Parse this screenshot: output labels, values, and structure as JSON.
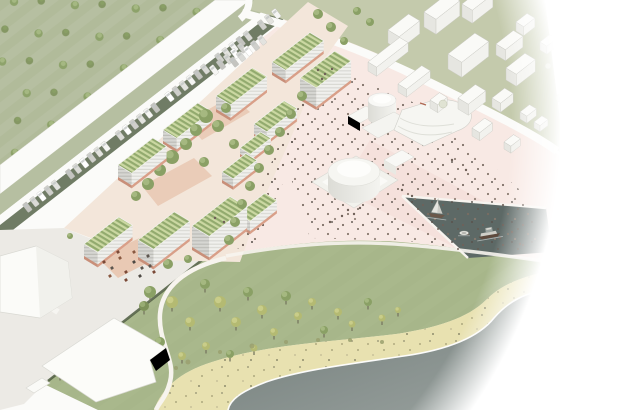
{
  "meta": {
    "alt": "Aerial architectural masterplan rendering in a circular vignette: green-roof campus, plaza, harbor basin with boats, meadow, beach and sea"
  },
  "palette": {
    "field": "#b6bfa1",
    "fieldStripe": "#adb795",
    "context": "#c4caac",
    "meadow": "#a9b88c",
    "meadowStripe": "#a0b081",
    "beach": "#e8e1b0",
    "seaTop": "#6f7a77",
    "seaBot": "#9ba3a0",
    "basin": "#5d6966",
    "white": "#fbfbf9",
    "grey": "#eceae5",
    "plaza": "#f8e9e4",
    "plaza2": "#f2dbd6",
    "campusGround": "#f3e6da",
    "court": "#e9c9b4",
    "hedge": "#4e5c40",
    "tree": "#8aa065",
    "treeLight": "#a9bc85",
    "treeDark": "#7d9159",
    "treeDarkHi": "#9cb078",
    "poplar": "#b4ba72",
    "poplarHi": "#ccd08d",
    "trunk": "#77775f",
    "roofA": "#cbd8a2",
    "roofB": "#92aa6e",
    "facL": "#d6d6d2",
    "facLLine": "#bdbdb8",
    "facR": "#f0f0ed",
    "facRLine": "#d9d9d4",
    "base": "#d99f88",
    "base2": "#c98f79",
    "ctxRoof": "#fafaf7",
    "ctxL": "#e6e6e1",
    "ctxR": "#f2f2ee",
    "ctxLine": "#c9c9c3",
    "sphere": "#e0e3d3",
    "sphereLine": "#c2c6b2",
    "bush": "#9aa06e",
    "dot": "#6f6058",
    "foam": "#ffffff",
    "sailHull": "#6b584a",
    "sail": "#e4e4df",
    "sail2": "#cbcbc5",
    "tugHull": "#5e4a3d",
    "tugDeck": "#cfcfc8",
    "tugCabin": "#9aa29e",
    "car_colors": [
      "#f5f5f3",
      "#e3e3df",
      "#cfcfcb",
      "#ffffff",
      "#dadad6",
      "#c4c4c0"
    ],
    "furn_colors": [
      "#7b4a37",
      "#5d564f",
      "#8a5a42",
      "#4e4a44"
    ]
  },
  "scene": {
    "vignette": {
      "cx": 61,
      "cy": 125,
      "r": 500
    },
    "axes": {
      "ux": 0.79,
      "uy": -0.614,
      "vx": 0.86,
      "vy": 0.52
    },
    "campus_buildings_back": [
      [
        272,
        62,
        48,
        16,
        13
      ],
      [
        300,
        78,
        44,
        19,
        22
      ],
      [
        216,
        96,
        46,
        17,
        16
      ],
      [
        254,
        124,
        38,
        15,
        13
      ],
      [
        163,
        130,
        44,
        16,
        14
      ],
      [
        240,
        148,
        26,
        12,
        9
      ]
    ],
    "campus_buildings_front": [
      [
        118,
        165,
        44,
        16,
        15
      ],
      [
        222,
        172,
        30,
        13,
        11
      ],
      [
        238,
        214,
        34,
        14,
        13
      ],
      [
        192,
        226,
        48,
        20,
        24
      ],
      [
        138,
        240,
        46,
        18,
        20
      ],
      [
        84,
        244,
        44,
        16,
        15
      ]
    ],
    "context_buildings": [
      [
        462,
        4,
        26,
        12,
        13
      ],
      [
        424,
        12,
        30,
        14,
        15
      ],
      [
        388,
        30,
        26,
        13,
        13
      ],
      [
        516,
        22,
        14,
        9,
        9
      ],
      [
        540,
        42,
        12,
        8,
        8
      ],
      [
        496,
        44,
        22,
        11,
        11
      ],
      [
        448,
        54,
        34,
        16,
        15
      ],
      [
        368,
        62,
        40,
        10,
        9
      ],
      [
        506,
        68,
        24,
        12,
        12
      ],
      [
        398,
        84,
        30,
        10,
        8
      ],
      [
        430,
        100,
        12,
        9,
        8
      ],
      [
        458,
        98,
        22,
        12,
        11
      ],
      [
        492,
        98,
        16,
        10,
        9
      ],
      [
        520,
        112,
        12,
        8,
        7
      ],
      [
        534,
        122,
        10,
        7,
        6
      ],
      [
        472,
        128,
        16,
        9,
        8
      ],
      [
        504,
        142,
        12,
        8,
        7
      ]
    ],
    "trees": {
      "courtyard": [
        [
          206,
          116,
          7
        ],
        [
          218,
          126,
          6
        ],
        [
          196,
          130,
          6
        ],
        [
          226,
          108,
          5
        ],
        [
          186,
          144,
          6
        ],
        [
          172,
          157,
          7
        ],
        [
          160,
          170,
          6
        ],
        [
          234,
          144,
          5
        ],
        [
          148,
          184,
          6
        ],
        [
          136,
          196,
          5
        ],
        [
          204,
          162,
          5
        ]
      ],
      "promenade": [
        [
          302,
          96,
          5
        ],
        [
          291,
          114,
          5
        ],
        [
          280,
          132,
          5
        ],
        [
          269,
          150,
          5
        ],
        [
          259,
          168,
          5
        ],
        [
          250,
          186,
          5
        ],
        [
          242,
          204,
          5
        ],
        [
          235,
          222,
          5
        ],
        [
          229,
          240,
          5
        ]
      ],
      "street": [
        [
          318,
          14,
          5
        ],
        [
          331,
          27,
          5
        ],
        [
          344,
          41,
          4
        ],
        [
          357,
          11,
          4
        ],
        [
          370,
          22,
          4
        ]
      ],
      "grey": [
        [
          168,
          264,
          5
        ],
        [
          188,
          259,
          4
        ],
        [
          95,
          243,
          4
        ],
        [
          112,
          251,
          4
        ],
        [
          70,
          236,
          3
        ]
      ],
      "hedge": [
        [
          60,
          372,
          5
        ],
        [
          88,
          350,
          5
        ],
        [
          116,
          328,
          5
        ],
        [
          144,
          306,
          5
        ]
      ],
      "slope": [
        [
          150,
          292,
          6
        ],
        [
          172,
          302,
          6
        ],
        [
          190,
          322,
          5
        ],
        [
          205,
          284,
          5
        ],
        [
          220,
          302,
          6
        ],
        [
          236,
          322,
          5
        ],
        [
          248,
          292,
          5
        ],
        [
          262,
          310,
          5
        ],
        [
          274,
          332,
          4
        ],
        [
          286,
          296,
          5
        ],
        [
          298,
          316,
          4
        ],
        [
          312,
          302,
          4
        ],
        [
          324,
          330,
          4
        ],
        [
          338,
          312,
          4
        ],
        [
          352,
          324,
          3.5
        ],
        [
          368,
          302,
          4
        ],
        [
          382,
          318,
          3.5
        ],
        [
          398,
          310,
          3
        ],
        [
          160,
          342,
          5
        ],
        [
          182,
          356,
          4
        ],
        [
          206,
          346,
          4
        ],
        [
          230,
          354,
          4
        ],
        [
          254,
          348,
          3.5
        ]
      ],
      "spheres": [
        [
          560,
          98,
          4
        ],
        [
          578,
          124,
          4
        ],
        [
          548,
          66,
          3
        ],
        [
          592,
          146,
          3
        ],
        [
          443,
          104,
          4
        ]
      ],
      "beach_bushes": [
        [
          188,
          362,
          2.5
        ],
        [
          220,
          352,
          2
        ],
        [
          252,
          346,
          2.5
        ],
        [
          286,
          342,
          2
        ],
        [
          318,
          340,
          2
        ],
        [
          350,
          340,
          2
        ],
        [
          382,
          342,
          2
        ],
        [
          176,
          368,
          2
        ]
      ]
    },
    "cars": {
      "main": {
        "base": [
          228,
          17
        ],
        "dir": [
          -0.79,
          0.614
        ],
        "normal": [
          0.614,
          0.79
        ],
        "offset": 27,
        "start": -40,
        "step": 9,
        "count": 36,
        "skip": [
          3,
          9,
          16,
          23,
          30
        ],
        "angle": -37.8,
        "size": [
          5.2,
          10
        ]
      },
      "side": [
        [
          242,
          48
        ],
        [
          235,
          53.5
        ],
        [
          228,
          59
        ],
        [
          221,
          64.5
        ],
        [
          214,
          70
        ],
        [
          262,
          40
        ],
        [
          255,
          45.5
        ],
        [
          248,
          51
        ],
        [
          241,
          56.5
        ],
        [
          234,
          62
        ]
      ]
    },
    "furniture": [
      [
        104,
        262,
        0
      ],
      [
        112,
        268,
        1
      ],
      [
        120,
        258,
        2
      ],
      [
        126,
        272,
        0
      ],
      [
        134,
        262,
        3
      ],
      [
        142,
        268,
        1
      ],
      [
        110,
        276,
        2
      ],
      [
        126,
        280,
        0
      ],
      [
        140,
        276,
        3
      ],
      [
        150,
        266,
        1
      ],
      [
        118,
        252,
        0
      ],
      [
        134,
        252,
        2
      ],
      [
        148,
        256,
        1
      ],
      [
        154,
        272,
        0
      ]
    ],
    "roof_people": [
      [
        318,
        70
      ],
      [
        325,
        74
      ],
      [
        332,
        69
      ],
      [
        322,
        79
      ],
      [
        215,
        218
      ],
      [
        224,
        222
      ]
    ],
    "plaza_extra_dots": [
      [
        348,
        210
      ],
      [
        354,
        214
      ],
      [
        360,
        208
      ],
      [
        342,
        216
      ],
      [
        402,
        190
      ],
      [
        412,
        196
      ],
      [
        330,
        222
      ],
      [
        500,
        238
      ],
      [
        512,
        232
      ],
      [
        520,
        244
      ],
      [
        452,
        160
      ],
      [
        466,
        170
      ]
    ],
    "boats": {
      "sail": {
        "x": 436,
        "y": 214,
        "rot": 8
      },
      "dinghy": {
        "x": 464,
        "y": 233
      },
      "tug": {
        "x": 489,
        "y": 233,
        "rot": -10
      }
    }
  }
}
